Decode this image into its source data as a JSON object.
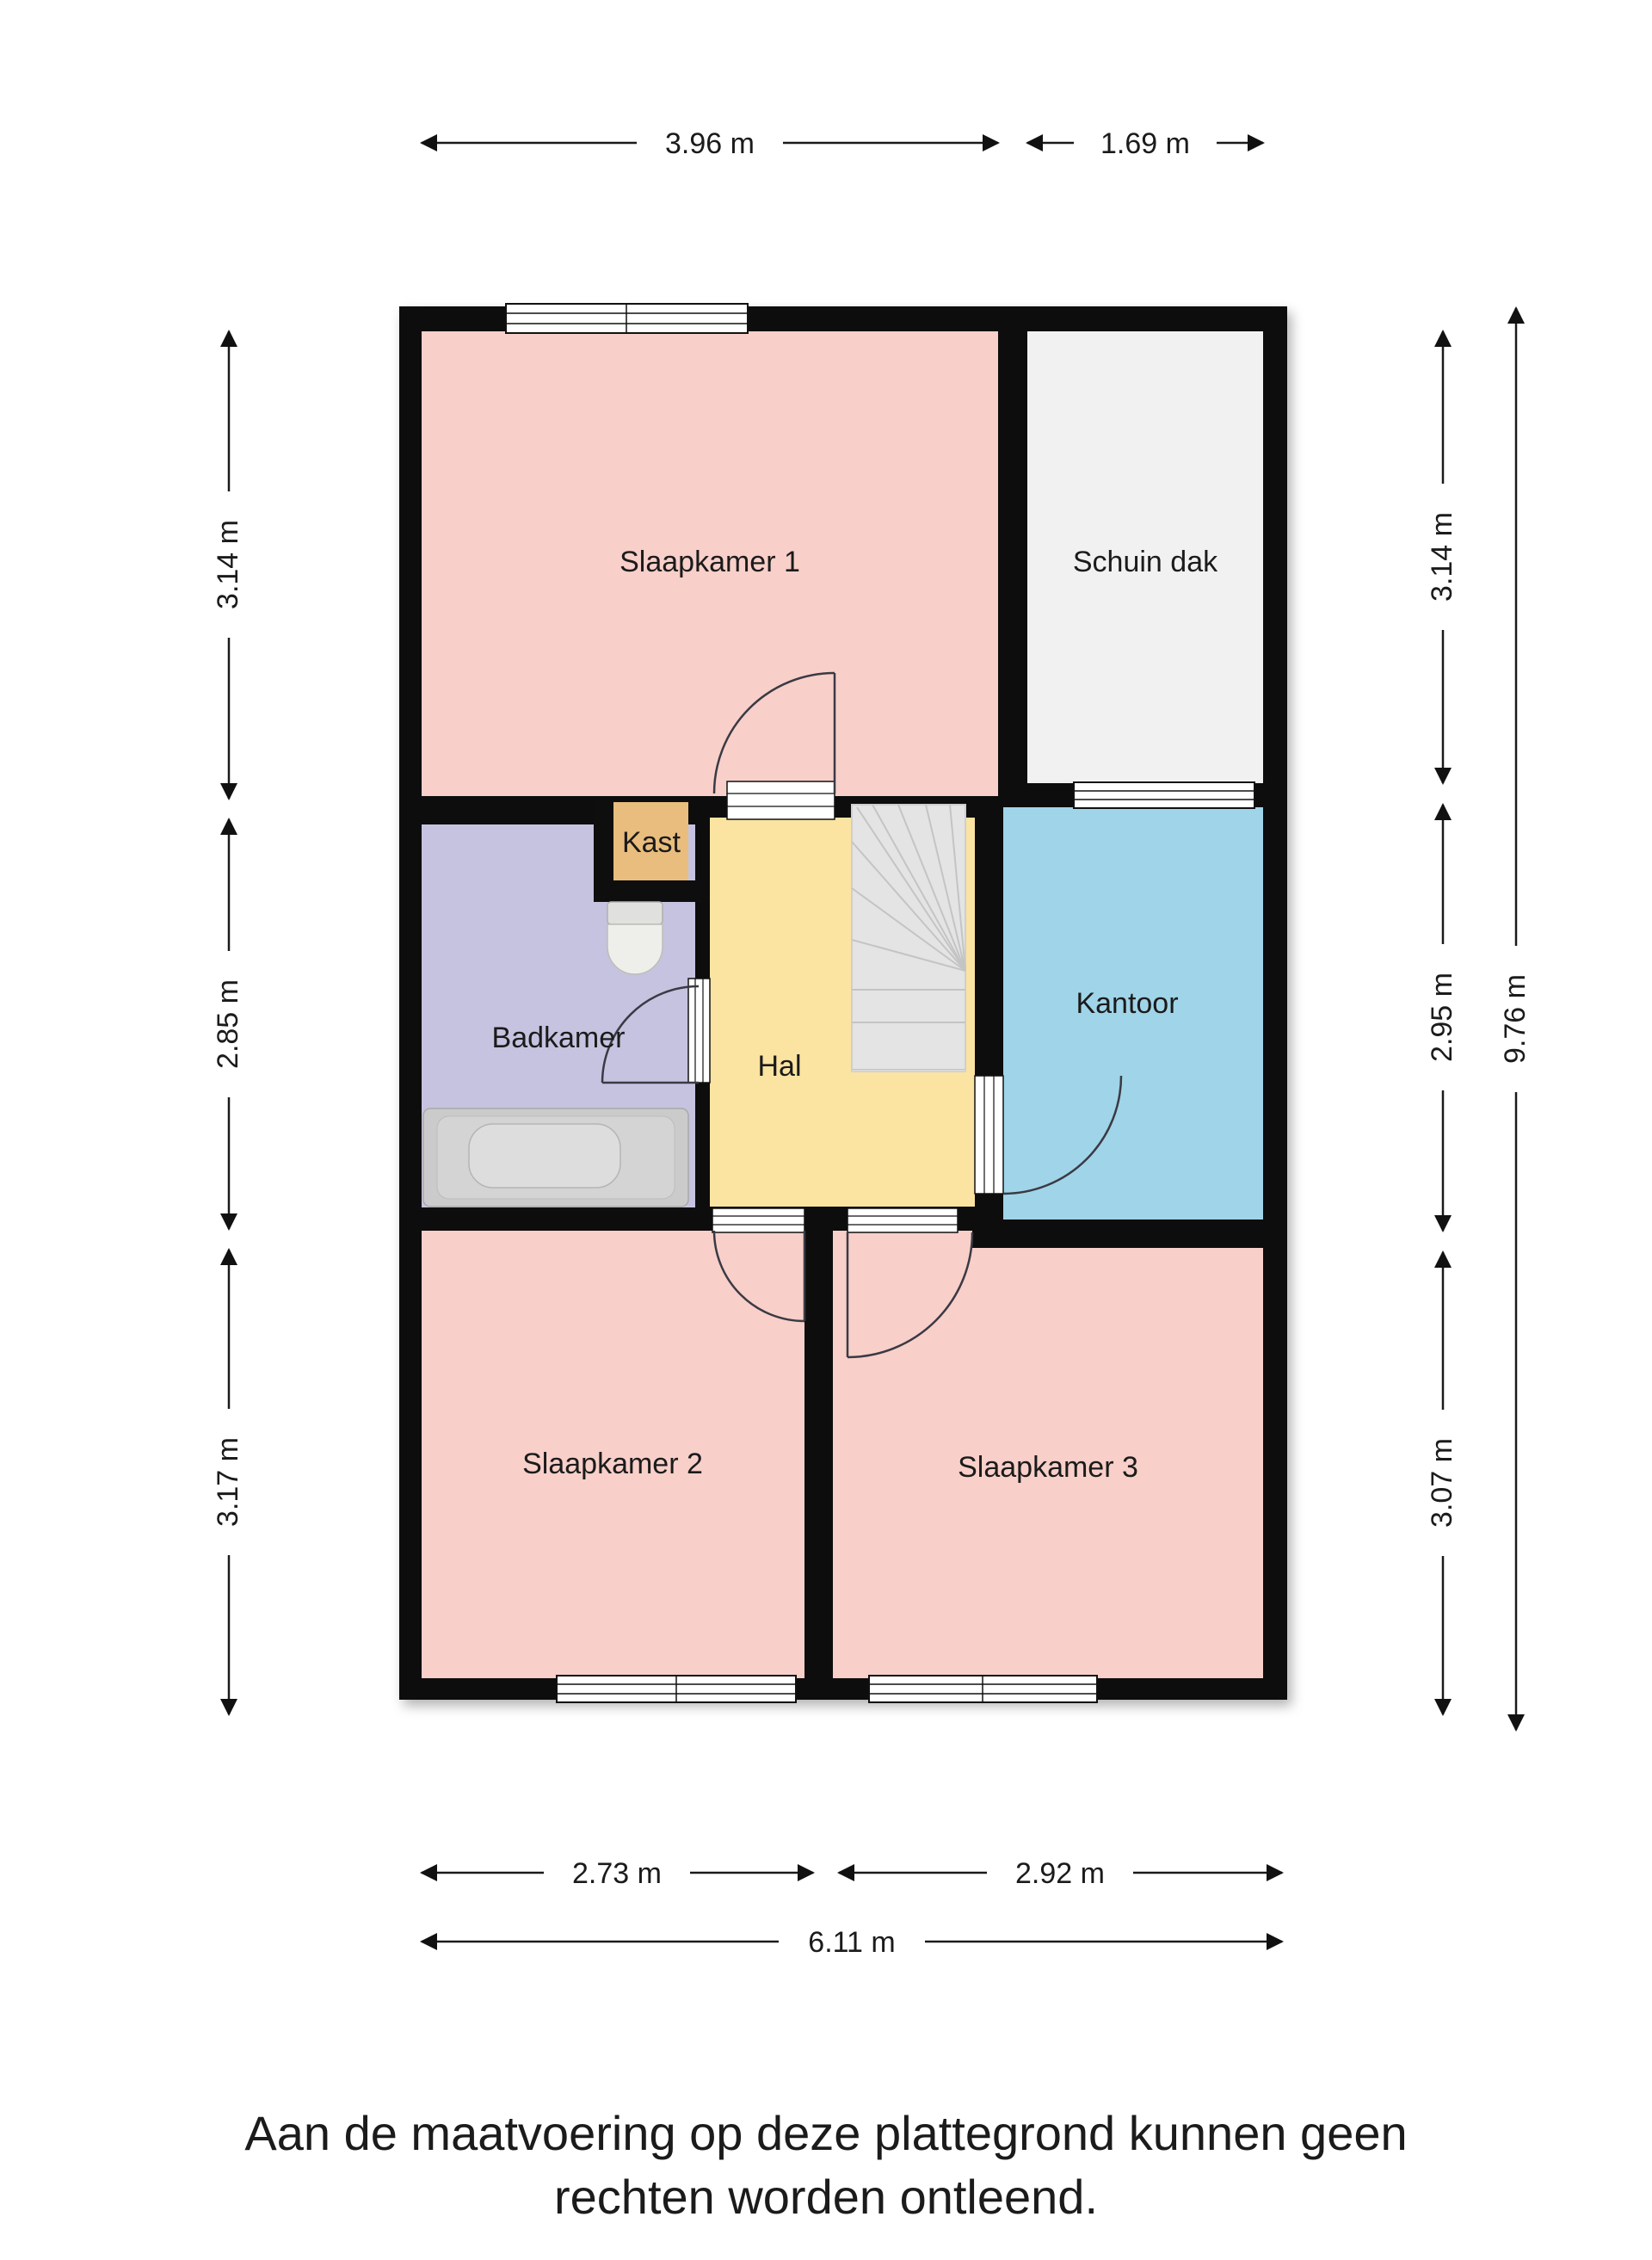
{
  "rooms": {
    "slaapkamer1": "Slaapkamer 1",
    "schuin_dak": "Schuin dak",
    "kast": "Kast",
    "badkamer": "Badkamer",
    "hal": "Hal",
    "kantoor": "Kantoor",
    "slaapkamer2": "Slaapkamer 2",
    "slaapkamer3": "Slaapkamer 3"
  },
  "dimensions": {
    "top": [
      {
        "label": "3.96 m"
      },
      {
        "label": "1.69 m"
      }
    ],
    "left": [
      {
        "label": "3.14 m"
      },
      {
        "label": "2.85 m"
      },
      {
        "label": "3.17 m"
      }
    ],
    "right": [
      {
        "label": "3.14 m"
      },
      {
        "label": "2.95 m"
      },
      {
        "label": "3.07 m"
      }
    ],
    "right_total": "9.76 m",
    "bottom": [
      {
        "label": "2.73 m"
      },
      {
        "label": "2.92 m"
      }
    ],
    "bottom_total": "6.11 m"
  },
  "disclaimer": {
    "line1": "Aan de maatvoering op deze plattegrond kunnen geen",
    "line2": "rechten worden ontleend."
  },
  "colors": {
    "wall": "#0e0e0e",
    "bedroom": "#f8cfc9",
    "bathroom": "#c6c3e0",
    "hall": "#fbe3a1",
    "office": "#a0d4e8",
    "closet": "#e9bd7d",
    "sloped_roof": "#f1f1f1",
    "stairs": "#e4e4e4",
    "fixture": "#d6d6d4"
  }
}
